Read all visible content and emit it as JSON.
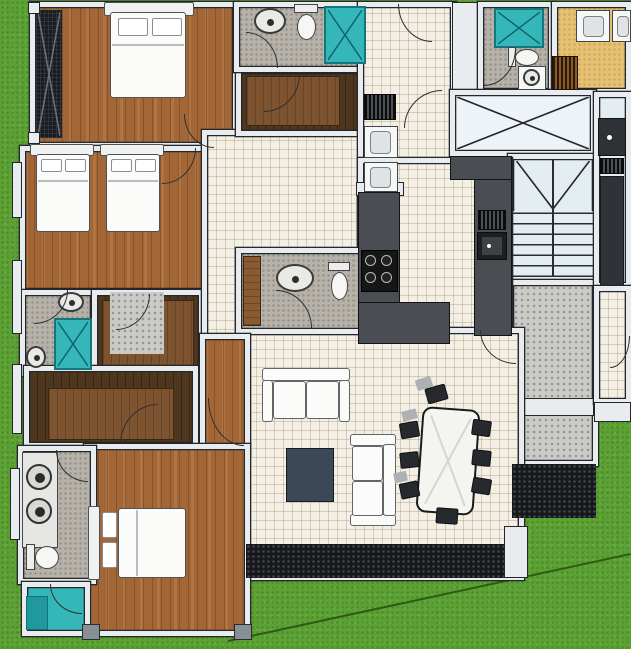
{
  "scene": {
    "description": "Top-down 3D architectural floor plan render of an apartment surrounded by lawn",
    "visible_text": "none"
  },
  "colors": {
    "grass": "#5ca133",
    "path_line": "#2e5a14",
    "wall": "#e9ecee",
    "wall_edge": "#23262b",
    "wood": "#a36636",
    "closet_floor": "#4f361e",
    "closet_rug": "#7d5330",
    "tile": "#f4efe5",
    "bath_floor": "#b7b2a9",
    "landing_floor": "#cacac6",
    "stair_floor": "#e4edf1",
    "elevator_floor": "#edf3f6",
    "teal": "#35b7b9",
    "teal_dark": "#1f989e",
    "tan": "#e6c173",
    "counter": "#4a4e53",
    "stove": "#161617",
    "hatch": "#17181b",
    "hatch_dot": "#45474c",
    "white_furniture": "#fbfbfa",
    "coffee_table": "#3c4856",
    "chair": "#26292d",
    "chair_ghost": "#aeb1b3",
    "wood_cabinet": "#8a5a30",
    "vent_brown": "#8a5a28",
    "dark_fixture": "#2e3135",
    "shaft": "#1b1d24"
  },
  "rooms": [
    {
      "id": "bedroom-1",
      "floor": "wood",
      "furniture": [
        "double-bed"
      ]
    },
    {
      "id": "bedroom-2",
      "floor": "wood",
      "furniture": [
        "single-bed",
        "single-bed"
      ]
    },
    {
      "id": "bathroom-1",
      "floor": "stone",
      "fixtures": [
        "sink",
        "shower",
        "toilet"
      ]
    },
    {
      "id": "walk-in-closet-1",
      "floor": "dark-wood-with-rug"
    },
    {
      "id": "walk-in-closet-2",
      "floor": "dark-wood-with-rug"
    },
    {
      "id": "walk-in-closet-3",
      "floor": "dark-wood-with-rug"
    },
    {
      "id": "master-bedroom",
      "floor": "wood",
      "furniture": [
        "double-bed"
      ]
    },
    {
      "id": "bathroom-2",
      "floor": "stone",
      "fixtures": [
        "double-vanity",
        "toilet"
      ]
    },
    {
      "id": "shower-room",
      "floor": "teal",
      "fixtures": [
        "shower-mat"
      ]
    },
    {
      "id": "hallway",
      "floor": "tile"
    },
    {
      "id": "powder-room",
      "floor": "stone",
      "fixtures": [
        "sink",
        "toilet",
        "wood-cabinet"
      ]
    },
    {
      "id": "bathroom-3",
      "floor": "stone",
      "fixtures": [
        "sink",
        "toilet",
        "shower"
      ]
    },
    {
      "id": "utility-corridor",
      "floor": "tile",
      "fixtures": [
        "vent",
        "appliance",
        "appliance"
      ]
    },
    {
      "id": "kitchen",
      "floor": "tile",
      "fixtures": [
        "l-counter",
        "stove",
        "sink-counter",
        "dish-rack"
      ]
    },
    {
      "id": "living-dining",
      "floor": "tile",
      "furniture": [
        "sofa-2seat",
        "sofa-2seat",
        "coffee-table",
        "dining-table",
        "chairs-x8"
      ]
    },
    {
      "id": "bathroom-4",
      "floor": "stone",
      "fixtures": [
        "shower",
        "toilet",
        "sink"
      ]
    },
    {
      "id": "laundry-balcony",
      "floor": "tan",
      "fixtures": [
        "appliance",
        "appliance",
        "vent"
      ]
    },
    {
      "id": "elevator-shaft",
      "floor": "light",
      "marking": "x-cross"
    },
    {
      "id": "staircase",
      "floor": "light",
      "marking": "treads-and-diagonals"
    },
    {
      "id": "entry-landing",
      "floor": "concrete-speckle"
    },
    {
      "id": "side-service-strip",
      "floor": "light",
      "fixtures": [
        "outdoor-sink",
        "duct-column"
      ]
    }
  ]
}
